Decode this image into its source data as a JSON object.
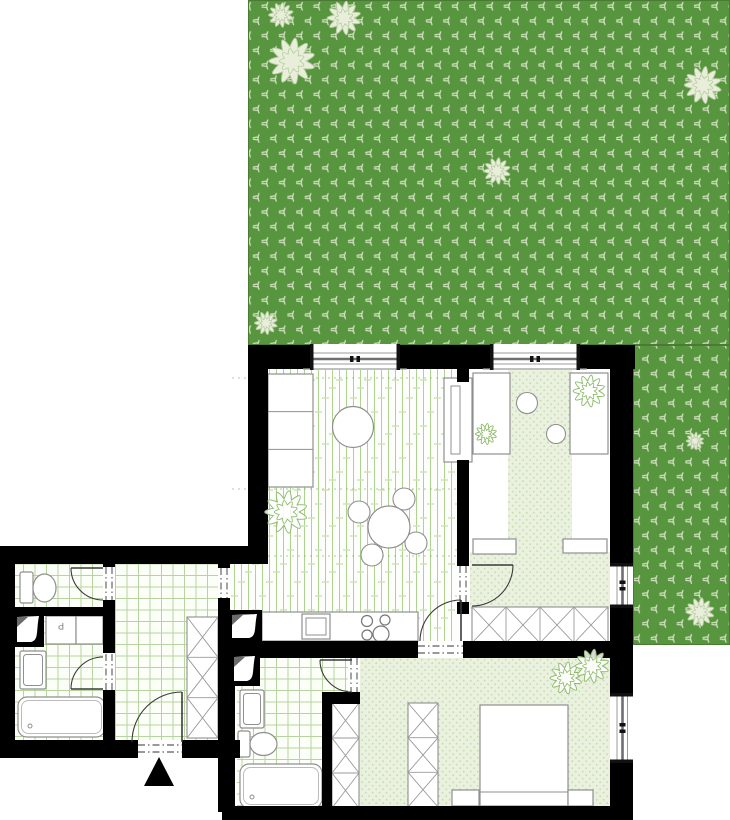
{
  "meta": {
    "type": "architectural-floor-plan",
    "width": 730,
    "height": 820
  },
  "labels": {
    "washing_machine": "P"
  },
  "colors": {
    "page_bg": "#ffffff",
    "garden_green": "#57953e",
    "grass": "#cddcbc",
    "garden_flower_fill": "#e9eedb",
    "garden_flower_stroke": "#b4cb9e",
    "wall": "#000000",
    "tile_bg": "#fcfef8",
    "tile_line": "#b7d3a0",
    "plank_bg": "#fdfefb",
    "plank_line": "#aed28f",
    "plank_accent": "#cbe3b4",
    "dot_bg": "#eaf1df",
    "dot": "#c6dcae",
    "plant_stroke": "#8fbb6d",
    "furniture_stroke": "#8f8f8f",
    "door_stroke": "#3a3a3a",
    "dash_stroke": "#333333",
    "frame_thin": "#9b9b9b",
    "frame_thick": "#6f6f6f",
    "joint_dash": "#7ab356"
  },
  "garden": {
    "rects": [
      [
        248,
        0,
        482,
        345
      ],
      [
        633,
        345,
        97,
        300
      ]
    ],
    "flowers": [
      [
        281,
        15,
        14
      ],
      [
        344,
        18,
        19
      ],
      [
        292,
        61,
        26
      ],
      [
        497,
        171,
        15
      ],
      [
        266,
        323,
        13
      ],
      [
        703,
        85,
        21
      ],
      [
        695,
        441,
        10
      ],
      [
        700,
        612,
        16
      ]
    ]
  },
  "floors": {
    "white": [
      [
        470,
        368,
        140,
        241
      ]
    ],
    "plank": [
      [
        268,
        368,
        189,
        246
      ],
      [
        230,
        564,
        227,
        77
      ]
    ],
    "dots": [
      [
        508,
        368,
        64,
        186
      ],
      [
        470,
        552,
        140,
        57
      ],
      [
        332,
        658,
        278,
        150
      ]
    ],
    "tile": [
      [
        15,
        564,
        88,
        45
      ],
      [
        15,
        616,
        88,
        124
      ],
      [
        115,
        564,
        103,
        176
      ],
      [
        237,
        658,
        113,
        44
      ],
      [
        237,
        700,
        85,
        108
      ]
    ]
  },
  "plank_joints": [
    378,
    489,
    556
  ],
  "walls": [
    [
      248,
      345,
      62,
      24
    ],
    [
      400,
      345,
      90,
      24
    ],
    [
      580,
      345,
      55,
      24
    ],
    [
      248,
      345,
      20,
      219
    ],
    [
      0,
      546,
      268,
      18
    ],
    [
      218,
      564,
      12,
      4
    ],
    [
      218,
      598,
      12,
      16
    ],
    [
      457,
      368,
      12,
      14
    ],
    [
      457,
      460,
      12,
      106
    ],
    [
      457,
      602,
      12,
      12
    ],
    [
      610,
      345,
      23,
      218
    ],
    [
      610,
      608,
      23,
      85
    ],
    [
      610,
      763,
      23,
      45
    ],
    [
      230,
      641,
      188,
      17
    ],
    [
      463,
      641,
      170,
      17
    ],
    [
      0,
      546,
      15,
      212
    ],
    [
      103,
      564,
      12,
      3
    ],
    [
      103,
      600,
      12,
      53
    ],
    [
      103,
      690,
      12,
      50
    ],
    [
      13,
      607,
      92,
      9
    ],
    [
      0,
      740,
      138,
      18
    ],
    [
      182,
      740,
      58,
      18
    ],
    [
      218,
      614,
      17,
      198
    ],
    [
      322,
      692,
      38,
      12
    ],
    [
      322,
      692,
      10,
      116
    ],
    [
      222,
      806,
      411,
      14
    ]
  ],
  "windows": [
    [
      310,
      344,
      90,
      26,
      "h"
    ],
    [
      490,
      344,
      90,
      26,
      "h"
    ],
    [
      610,
      563,
      23,
      45,
      "v"
    ],
    [
      610,
      693,
      23,
      70,
      "v"
    ]
  ],
  "door_openings": [
    [
      138,
      741,
      44,
      15,
      "h"
    ],
    [
      418,
      642,
      45,
      15,
      "h"
    ],
    [
      457,
      566,
      12,
      36,
      "v"
    ],
    [
      103,
      567,
      12,
      33,
      "v"
    ],
    [
      103,
      654,
      12,
      36,
      "v"
    ],
    [
      218,
      568,
      12,
      30,
      "v"
    ],
    [
      348,
      658,
      12,
      34,
      "v"
    ]
  ],
  "door_arcs": [
    {
      "d": "M132,742 A50,50 0 0 1 182,692",
      "leaf": [
        182,
        692,
        182,
        742
      ]
    },
    {
      "d": "M71,568 A32,32 0 0 0 103,600",
      "leaf": [
        71,
        568,
        103,
        568
      ]
    },
    {
      "d": "M71,689 A32,32 0 0 1 103,657",
      "leaf": [
        71,
        689,
        103,
        689
      ]
    },
    {
      "d": "M513,565 A41,41 0 0 1 472,606",
      "leaf": [
        472,
        565,
        513,
        565
      ]
    },
    {
      "d": "M461,600 A41,41 0 0 0 420,641",
      "leaf": [
        461,
        600,
        461,
        641
      ]
    },
    {
      "d": "M320,660 A32,32 0 0 0 352,692",
      "leaf": [
        320,
        660,
        352,
        660
      ]
    }
  ],
  "plants": [
    [
      286,
      512,
      24
    ],
    [
      589,
      391,
      18
    ],
    [
      486,
      434,
      12
    ],
    [
      566,
      678,
      18
    ],
    [
      592,
      666,
      19
    ]
  ],
  "wardrobes": [
    [
      472,
      607,
      136,
      36,
      4
    ],
    [
      187,
      617,
      31,
      121,
      3
    ],
    [
      332,
      703,
      27,
      105,
      3
    ],
    [
      408,
      703,
      30,
      104,
      3
    ]
  ],
  "shafts": [
    [
      13,
      612,
      31,
      35
    ],
    [
      228,
      610,
      34,
      33
    ],
    [
      230,
      652,
      30,
      34
    ]
  ],
  "furniture": {
    "sofa": [
      268,
      374,
      45,
      113
    ],
    "coffee_table": [
      353,
      427,
      20.5
    ],
    "cabinet": [
      444,
      378,
      28,
      84
    ],
    "dining_table": [
      389,
      527,
      21
    ],
    "dining_chairs": [
      [
        404,
        499,
        11
      ],
      [
        359,
        512,
        11
      ],
      [
        372,
        555,
        11
      ],
      [
        416,
        543,
        11
      ]
    ],
    "kitchen_counter": [
      262,
      612,
      156,
      29
    ],
    "kitchen_sink": [
      302,
      614,
      28,
      25
    ],
    "cooktop": [
      [
        367,
        621,
        5.5
      ],
      [
        385,
        620,
        5
      ],
      [
        367,
        635,
        5
      ],
      [
        381,
        634,
        8
      ]
    ],
    "beds_room1": [
      [
        473,
        373,
        37,
        81
      ],
      [
        570,
        373,
        38,
        81
      ]
    ],
    "bed_lamps": [
      [
        527,
        403,
        10.5
      ],
      [
        556,
        434,
        9.5
      ]
    ],
    "bench_rects": [
      [
        473,
        539,
        43,
        15
      ],
      [
        563,
        539,
        44,
        14
      ]
    ],
    "bed_room2": [
      480,
      705,
      88,
      101
    ],
    "nightstands": [
      [
        452,
        790,
        27,
        16
      ],
      [
        568,
        790,
        25,
        16
      ]
    ],
    "toilets": [
      {
        "tank": [
          20,
          572,
          13,
          31
        ],
        "bowl": [
          44.5,
          588,
          11.5,
          14
        ]
      },
      {
        "tank": [
          238,
          731,
          12,
          26
        ],
        "bowl": [
          263.5,
          744,
          13.5,
          11.5
        ]
      }
    ],
    "sinks": [
      [
        20,
        651,
        26,
        38
      ],
      [
        240,
        690,
        24,
        38
      ]
    ],
    "bathtubs": [
      [
        18,
        697,
        87,
        40
      ],
      [
        240,
        764,
        82,
        44
      ]
    ],
    "washer": [
      46,
      616,
      30,
      28
    ],
    "appliance_box": [
      76,
      616,
      27,
      28
    ]
  },
  "entrance_marker": [
    [
      159,
      757
    ],
    [
      144,
      786
    ],
    [
      174,
      786
    ]
  ]
}
